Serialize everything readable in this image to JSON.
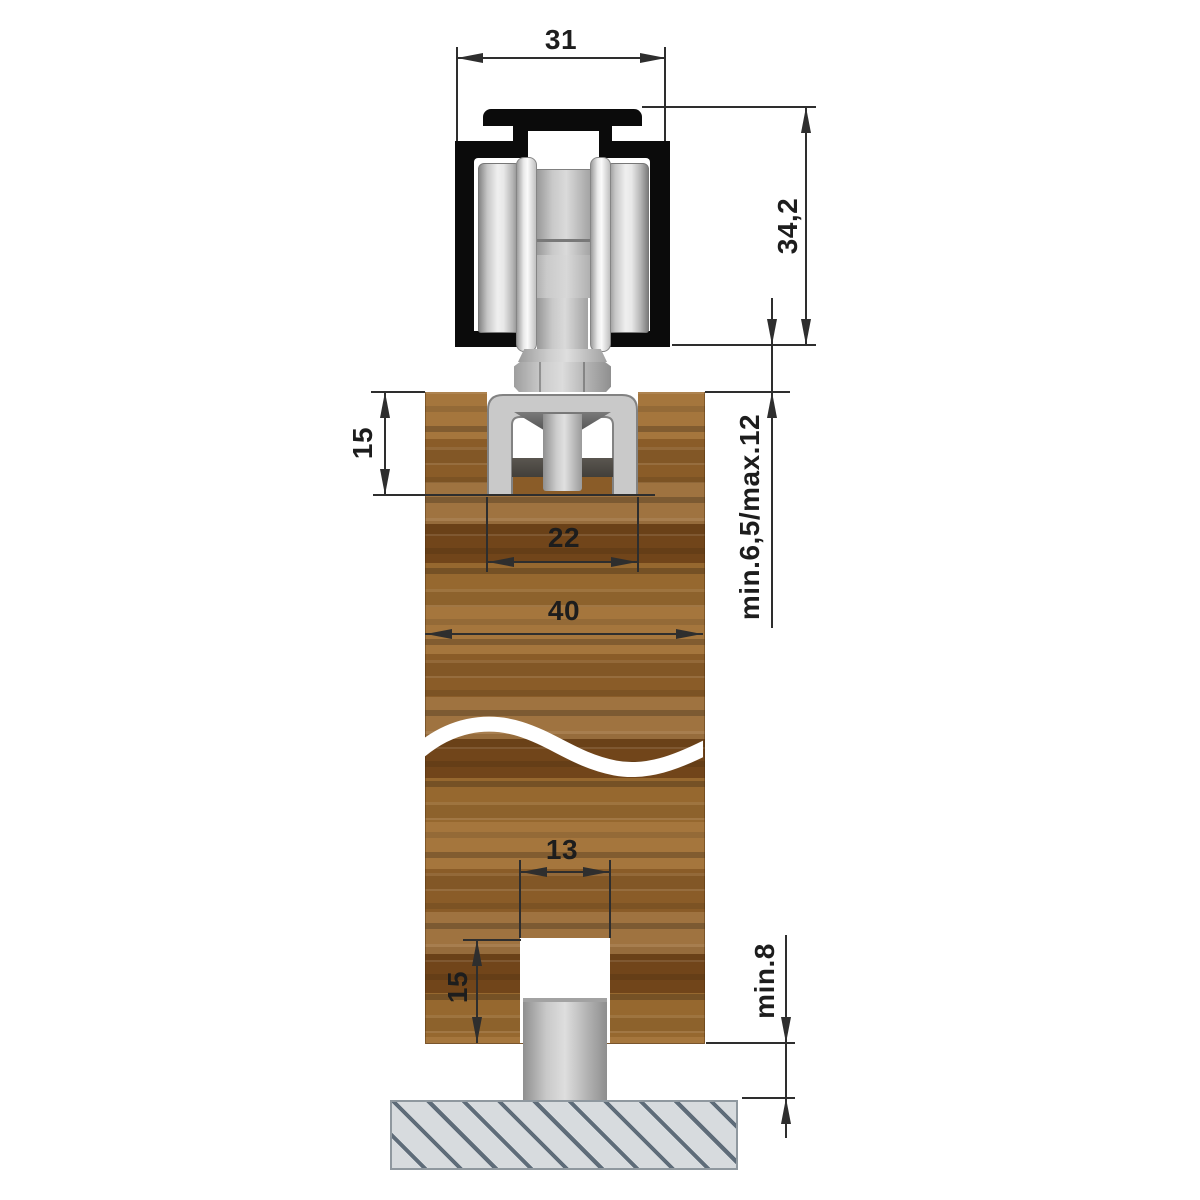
{
  "drawing": {
    "kind": "technical cross-section",
    "subject": "top-hung sliding door roller track with wooden door, floor guide pin and floor slab"
  },
  "dims": {
    "track_width": "31",
    "assembly_height": "34,2",
    "fitting_recess_depth": "15",
    "fitting_width": "22",
    "door_thickness": "40",
    "track_to_door_gap": "min.6,5/max.12",
    "floor_groove_width": "13",
    "floor_groove_depth": "15",
    "door_to_floor_gap": "min.8"
  },
  "colors": {
    "black": "#0b0b0b",
    "dim": "#2e2e2e",
    "wood-a": "#a5763d",
    "wood-b": "#8a5c28",
    "wood-c": "#71451a",
    "floor-fill": "#d7dbde",
    "hatch": "#5e6c79"
  }
}
